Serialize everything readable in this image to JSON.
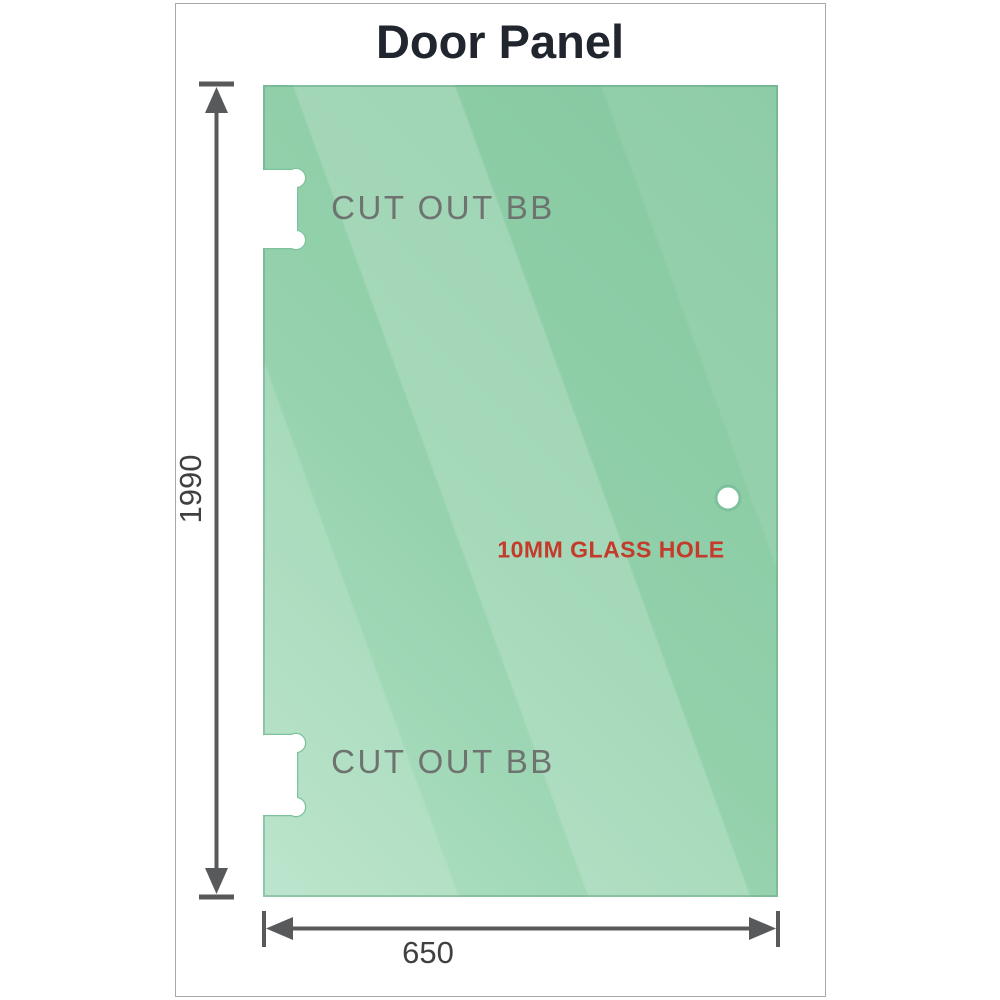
{
  "title": "Door Panel",
  "panel": {
    "glass_color": "#8ccea6",
    "glass_light_color": "#abdec0",
    "edge_color": "#7dc29c",
    "cutouts": [
      {
        "label": "CUT OUT BB"
      },
      {
        "label": "CUT OUT BB"
      }
    ],
    "hole": {
      "label": "10MM GLASS HOLE",
      "label_color": "#c43b2c"
    }
  },
  "dimensions": {
    "height": "1990",
    "width": "650",
    "line_color": "#58595b"
  }
}
